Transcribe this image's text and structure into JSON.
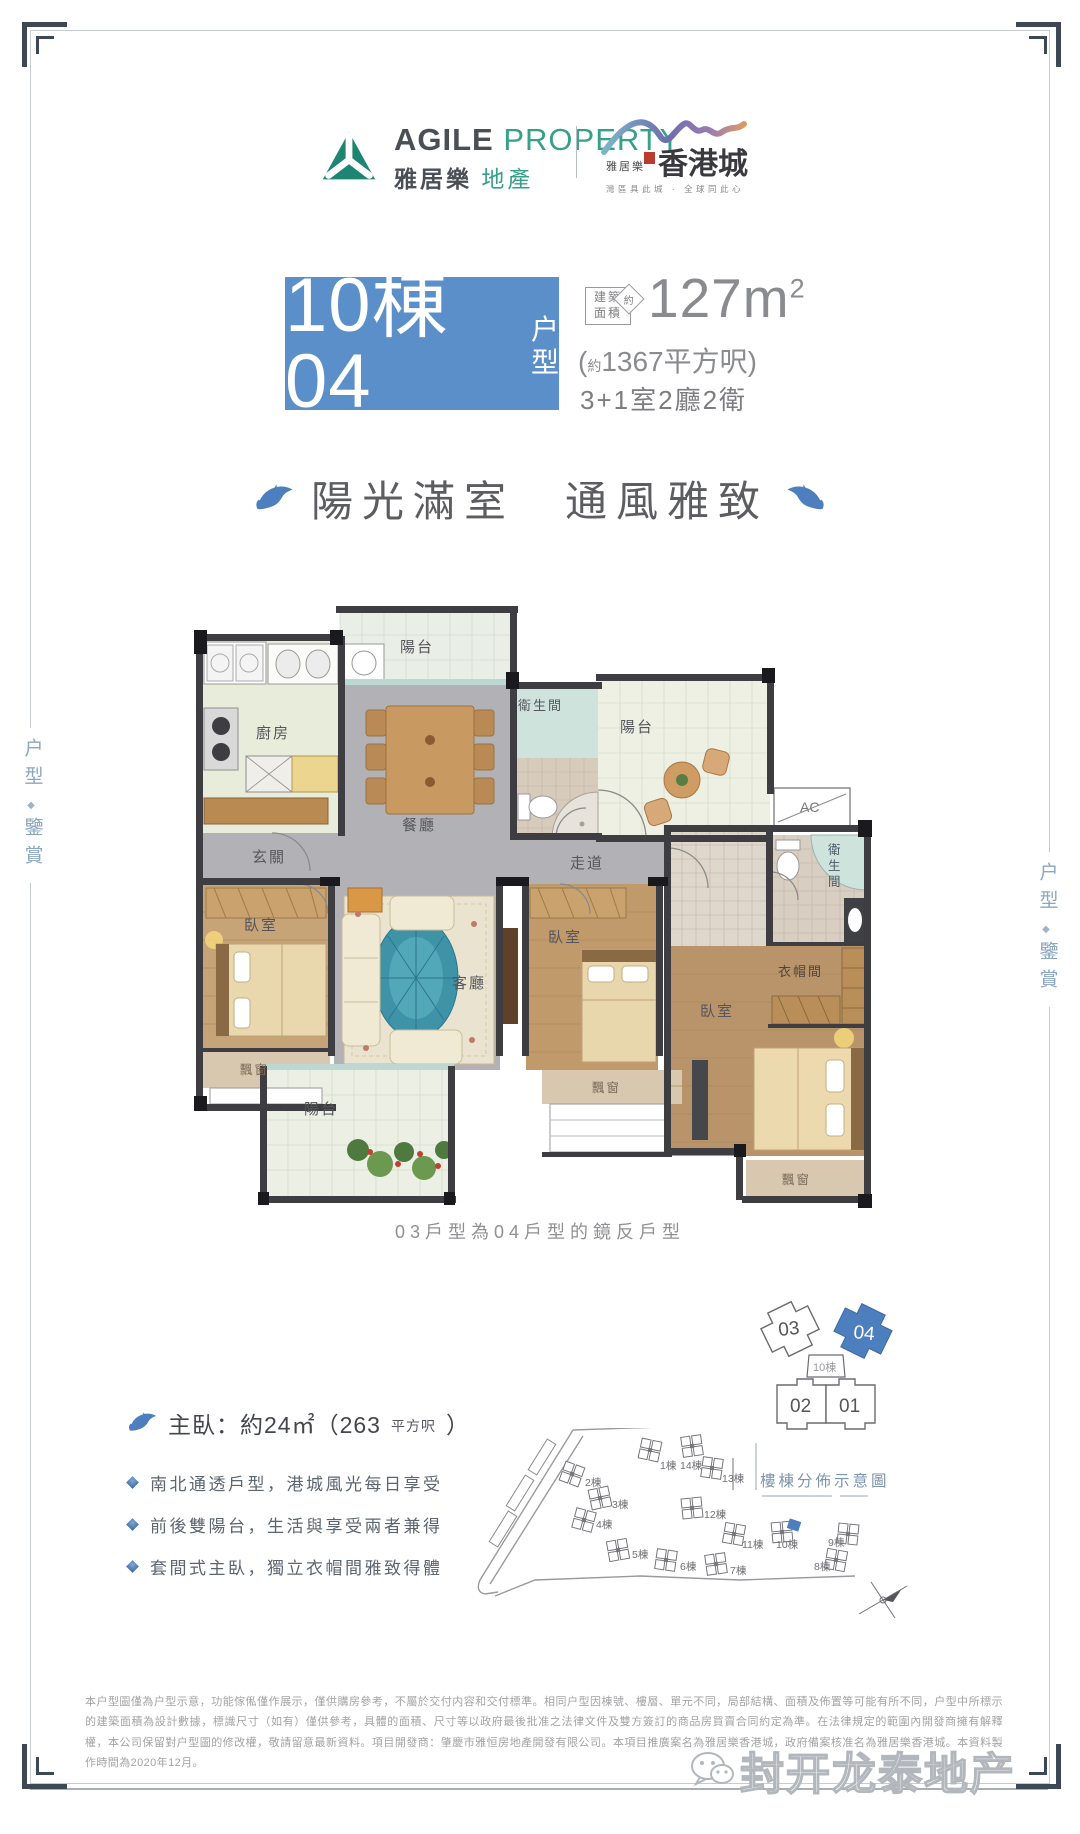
{
  "frame": {
    "side_label_top": "户型",
    "side_label_diamond": "◆",
    "side_label_bottom": "鑒賞"
  },
  "header": {
    "agile": {
      "en_bold": "AGILE",
      "en_light": "PROPERTY",
      "cn_bold": "雅居樂",
      "cn_light": "地產"
    },
    "project": {
      "small_brand": "雅居樂",
      "name": "香港城",
      "tagline": "灣區具此城 · 全球同此心"
    }
  },
  "title": {
    "unit_block": "10棟04",
    "unit_type_1": "户",
    "unit_type_2": "型",
    "area_tag_l1": "建築",
    "area_tag_l2": "面積",
    "area_tag_approx": "約",
    "area_main": "127m",
    "area_sup": "2",
    "area_paren_open": "(",
    "area_paren_approx": "約",
    "area_paren_text": "1367平方呎)",
    "spec": "3+1室2廳2衛"
  },
  "slogan": {
    "left": "陽光滿室",
    "right": "通風雅致"
  },
  "floorplan": {
    "labels": {
      "balcony_top": "陽台",
      "kitchen": "廚房",
      "bath1": "衛生間",
      "balcony_right": "陽台",
      "ac": "AC",
      "dining": "餐廳",
      "entry": "玄關",
      "corridor": "走道",
      "bed_left": "臥室",
      "living": "客廳",
      "bed_mid": "臥室",
      "bed_master": "臥室",
      "wardrobe": "衣帽間",
      "bath2_c1": "衛",
      "bath2_c2": "生",
      "bath2_c3": "間",
      "bay_left": "飄窗",
      "bay_mid": "飄窗",
      "bay_master": "飄窗",
      "balcony_bottom": "陽台"
    },
    "caption": "03戶型為04戶型的鏡反戶型"
  },
  "unit_key": {
    "u03": "03",
    "u04": "04",
    "u02": "02",
    "u01": "01",
    "building": "10棟"
  },
  "master_info": {
    "prefix": "主臥：約24㎡（263",
    "small": "平方呎",
    "suffix": "）"
  },
  "features": [
    {
      "text": "南北通透戶型，港城風光每日享受"
    },
    {
      "text": "前後雙陽台，生活與享受兩者兼得"
    },
    {
      "text": "套間式主臥，獨立衣帽間雅致得體"
    }
  ],
  "siteplan": {
    "title": "樓棟分佈示意圖",
    "buildings": [
      {
        "label": "1棟"
      },
      {
        "label": "14棟"
      },
      {
        "label": "2棟"
      },
      {
        "label": "13棟"
      },
      {
        "label": "3棟"
      },
      {
        "label": "4棟"
      },
      {
        "label": "12棟"
      },
      {
        "label": "11棟"
      },
      {
        "label": "10棟"
      },
      {
        "label": "9棟"
      },
      {
        "label": "5棟"
      },
      {
        "label": "6棟"
      },
      {
        "label": "7棟"
      },
      {
        "label": "8棟"
      }
    ]
  },
  "disclaimer": "本户型圖僅為户型示意，功能傢俬僅作展示，僅供購房參考，不屬於交付内容和交付標準。相同户型因棟號、樓層、單元不同，局部結構、面積及佈置等可能有所不同，户型中所標示的建築面積為設計數據，標識尺寸（如有）僅供參考，具體的面積、尺寸等以政府最後批准之法律文件及雙方簽訂的商品房買賣合同約定為準。在法律規定的範圍內開發商擁有解釋權，本公司保留對户型圖的修改權，敬請留意最新資料。項目開發商：肇慶市雅恒房地產開發有限公司。本項目推廣案名為雅居樂香港城，政府備案核准名為雅居樂香港城。本資料製作時間為2020年12月。",
  "watermark": "封开龙泰地产",
  "colors": {
    "accent_blue": "#5b8fc9",
    "unit_highlight": "#4d7fbe",
    "brand_green": "#1e8573"
  }
}
